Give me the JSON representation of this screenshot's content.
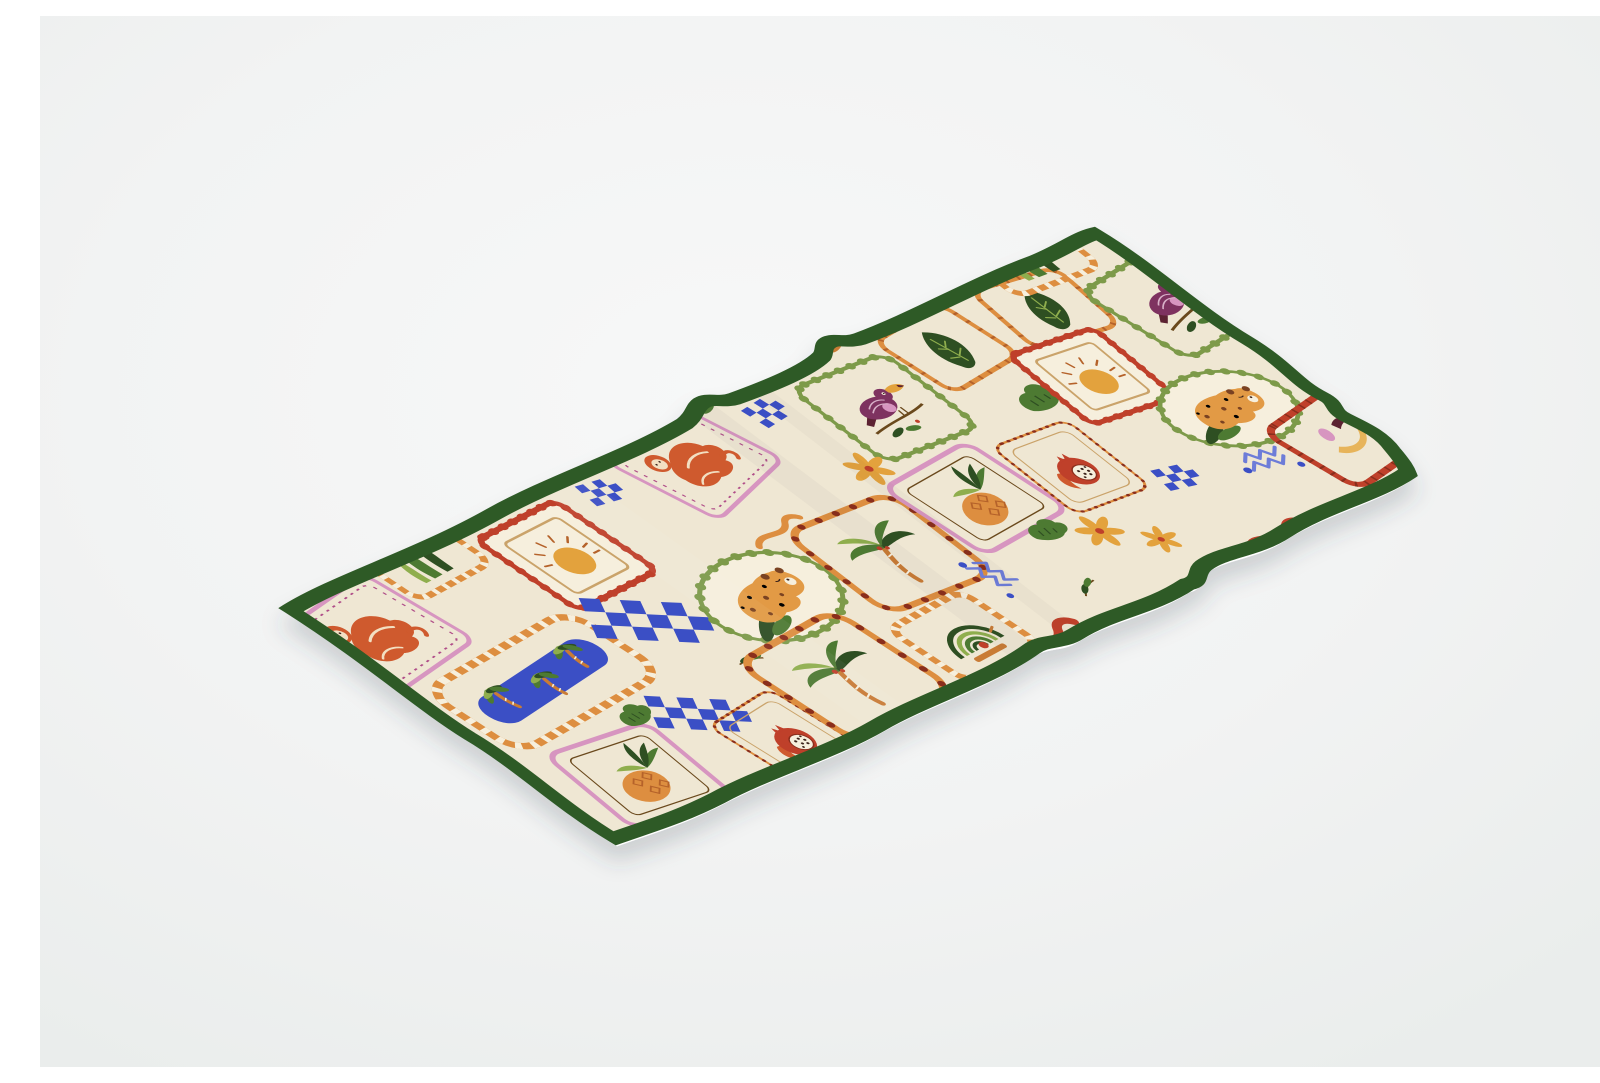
{
  "meta": {
    "type": "product-mockup",
    "item": "fabric table runner with tropical block-print pattern",
    "view": "isometric flat-lay with rippled wavy edges and soft drop shadow",
    "alt": "Cream tropical-print table runner with dark green binding, shown flat at an angle on a light studio background"
  },
  "colors": {
    "pagebg": "#f2f3f3",
    "pagebg_edge": "#eaedec",
    "cream_white": "#f7f8f8",
    "cream": "#efe7d3",
    "cream2": "#f6efdd",
    "border_green": "#2f5a27",
    "white": "#ffffff",
    "orange": "#dd8e3f",
    "burnt": "#b5622a",
    "rust": "#c97b35",
    "red": "#bf3f2a",
    "darkred": "#8a2f1d",
    "cobalt": "#3b4fc5",
    "periwinkle": "#6d7bd8",
    "pink": "#d795c0",
    "pinkdark": "#b04e88",
    "ribbonpurple": "#c287b8",
    "maroon": "#7e3060",
    "maroondark": "#5c2430",
    "olive": "#7d9a4a",
    "leaf": "#4e7a33",
    "leafdark": "#2f4f22",
    "leaflight": "#8fae4e",
    "sun": "#e3a23c",
    "fruit": "#e29a45",
    "spot": "#7a4220",
    "banana": "#e7b45a",
    "monkey": "#cf5a2d",
    "tan": "#caa36a",
    "branch": "#6b4a1e",
    "seed": "#3a241a",
    "face": "#f2dfc2",
    "shadow": "#36404d"
  },
  "motifs": [
    "orangutan in pink frame",
    "rising sun in red zigzag frame",
    "toucan in green scalloped frame",
    "jungle leaf in orange frame",
    "sleeping leopard in green scalloped oval",
    "palm tree in dotted orange frame",
    "pineapple in pink frame",
    "pomegranate in dotted frame",
    "blue river with palm trees in checkered frame",
    "blue checkerboard strip",
    "blue checker cluster",
    "marigold flower",
    "green bush",
    "rooster-tail arcs in striped frame",
    "blue zigzag with dots",
    "red wavy ribbon",
    "purple wavy ribbon",
    "banana and toucan beak in red frame",
    "aloe leaves in striped frame"
  ]
}
